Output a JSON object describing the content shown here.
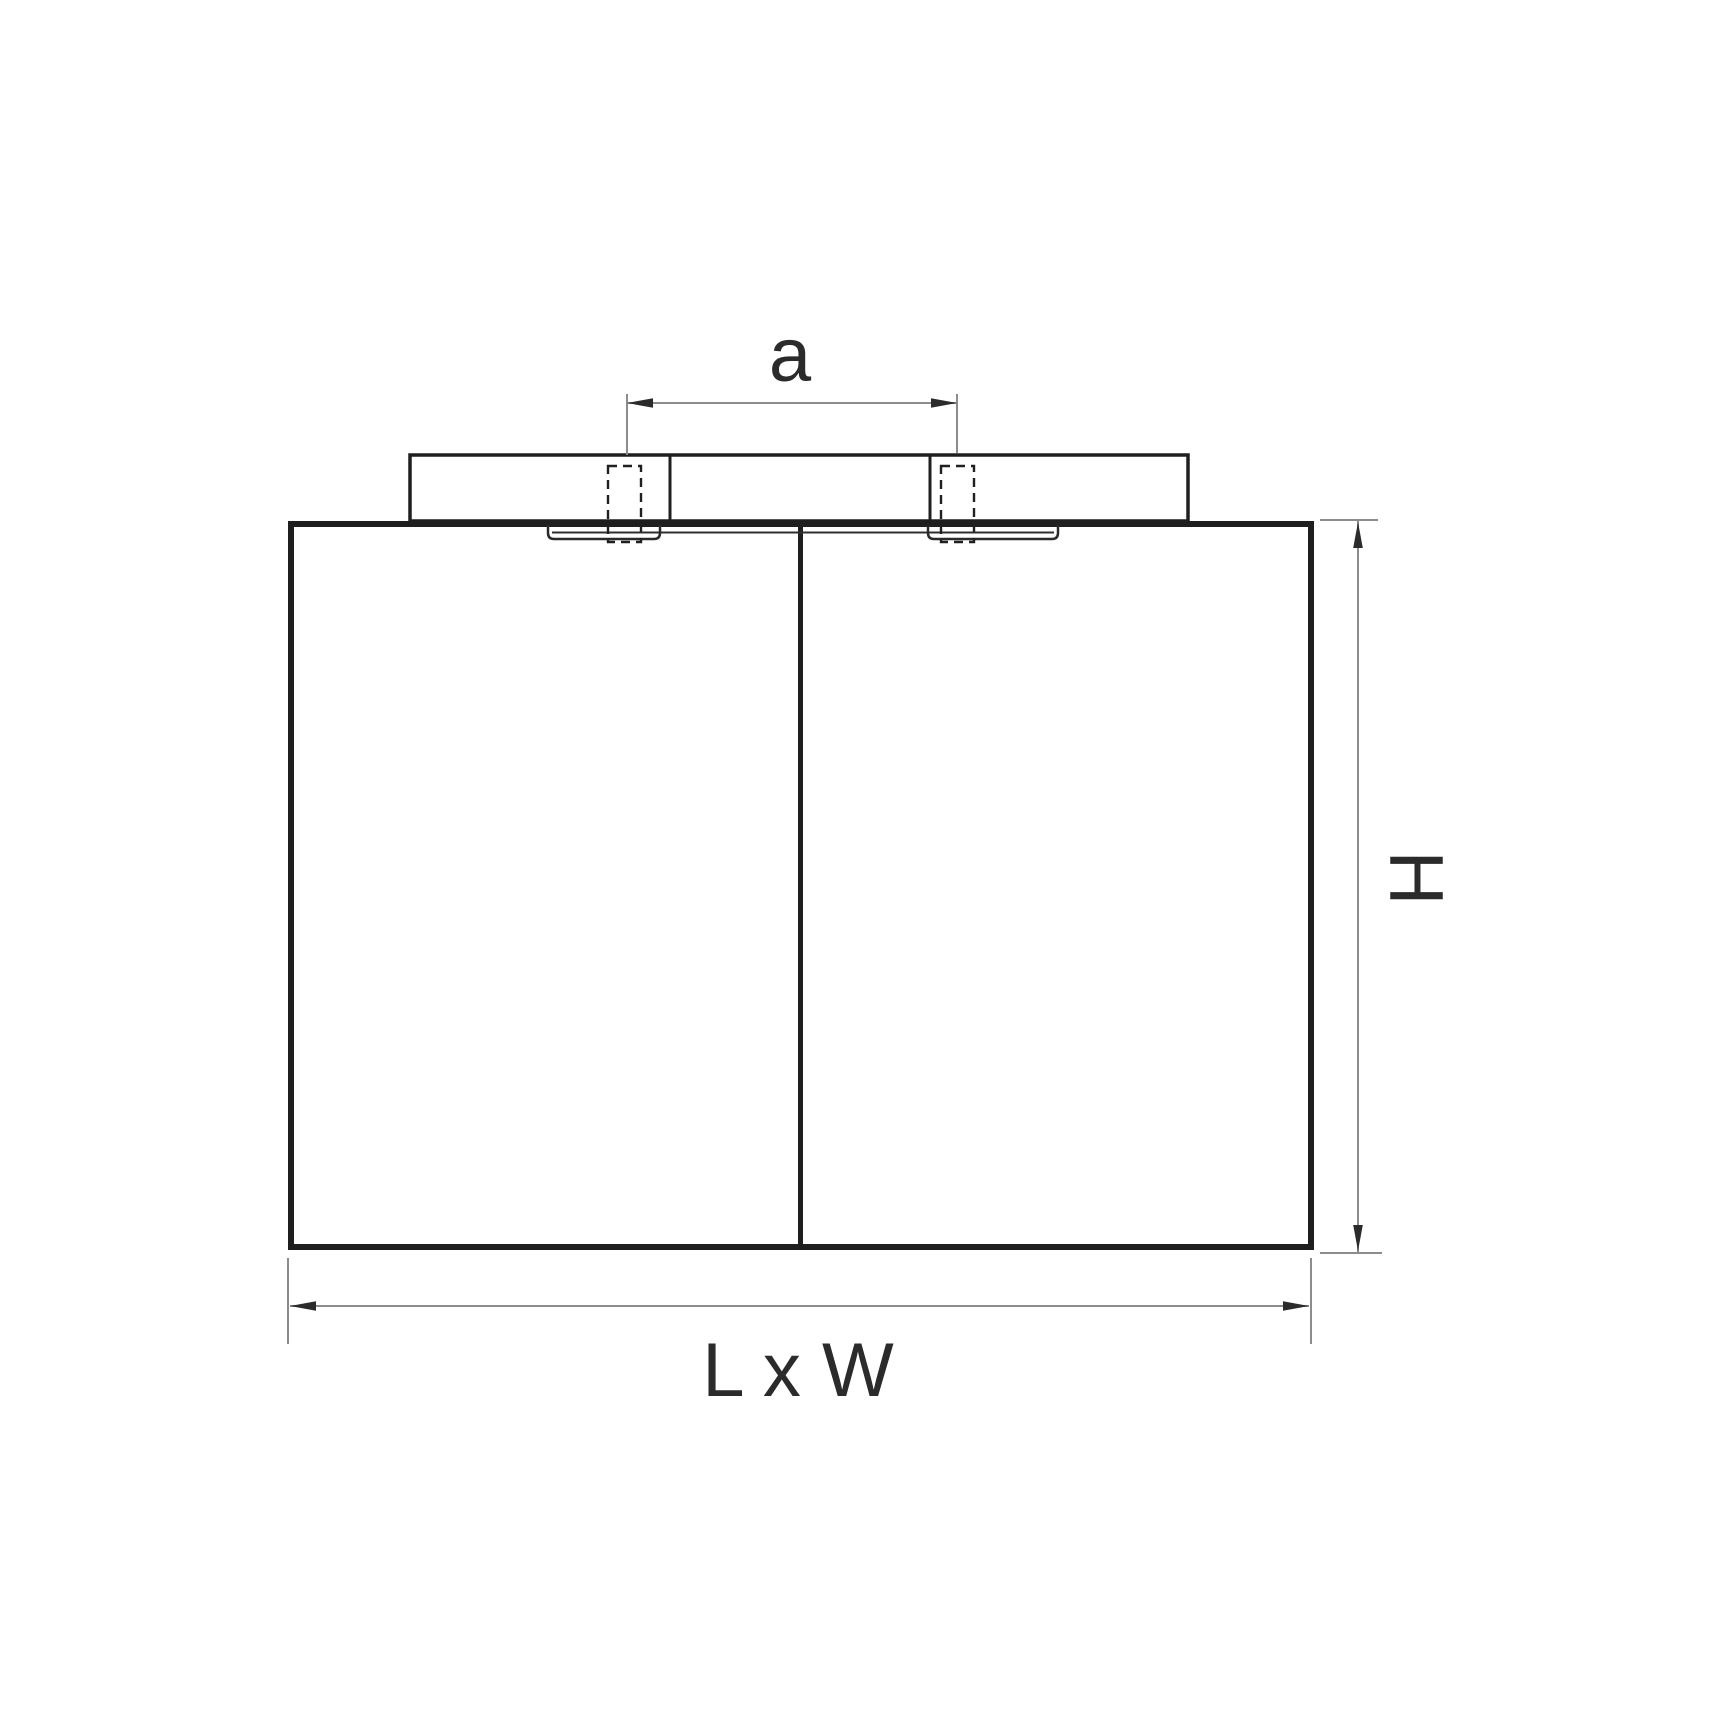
{
  "drawing": {
    "type": "luminaire-mounting-dimension-diagram",
    "labels": {
      "mounting_hole_spacing": "a",
      "height": "H",
      "footprint": "L x W"
    },
    "colors": {
      "background": "#ffffff",
      "outline": "#1f1f1f",
      "dimension_line": "#8c8c8c",
      "arrowhead": "#2b2b2b",
      "label_text": "#2b2b2b"
    }
  }
}
